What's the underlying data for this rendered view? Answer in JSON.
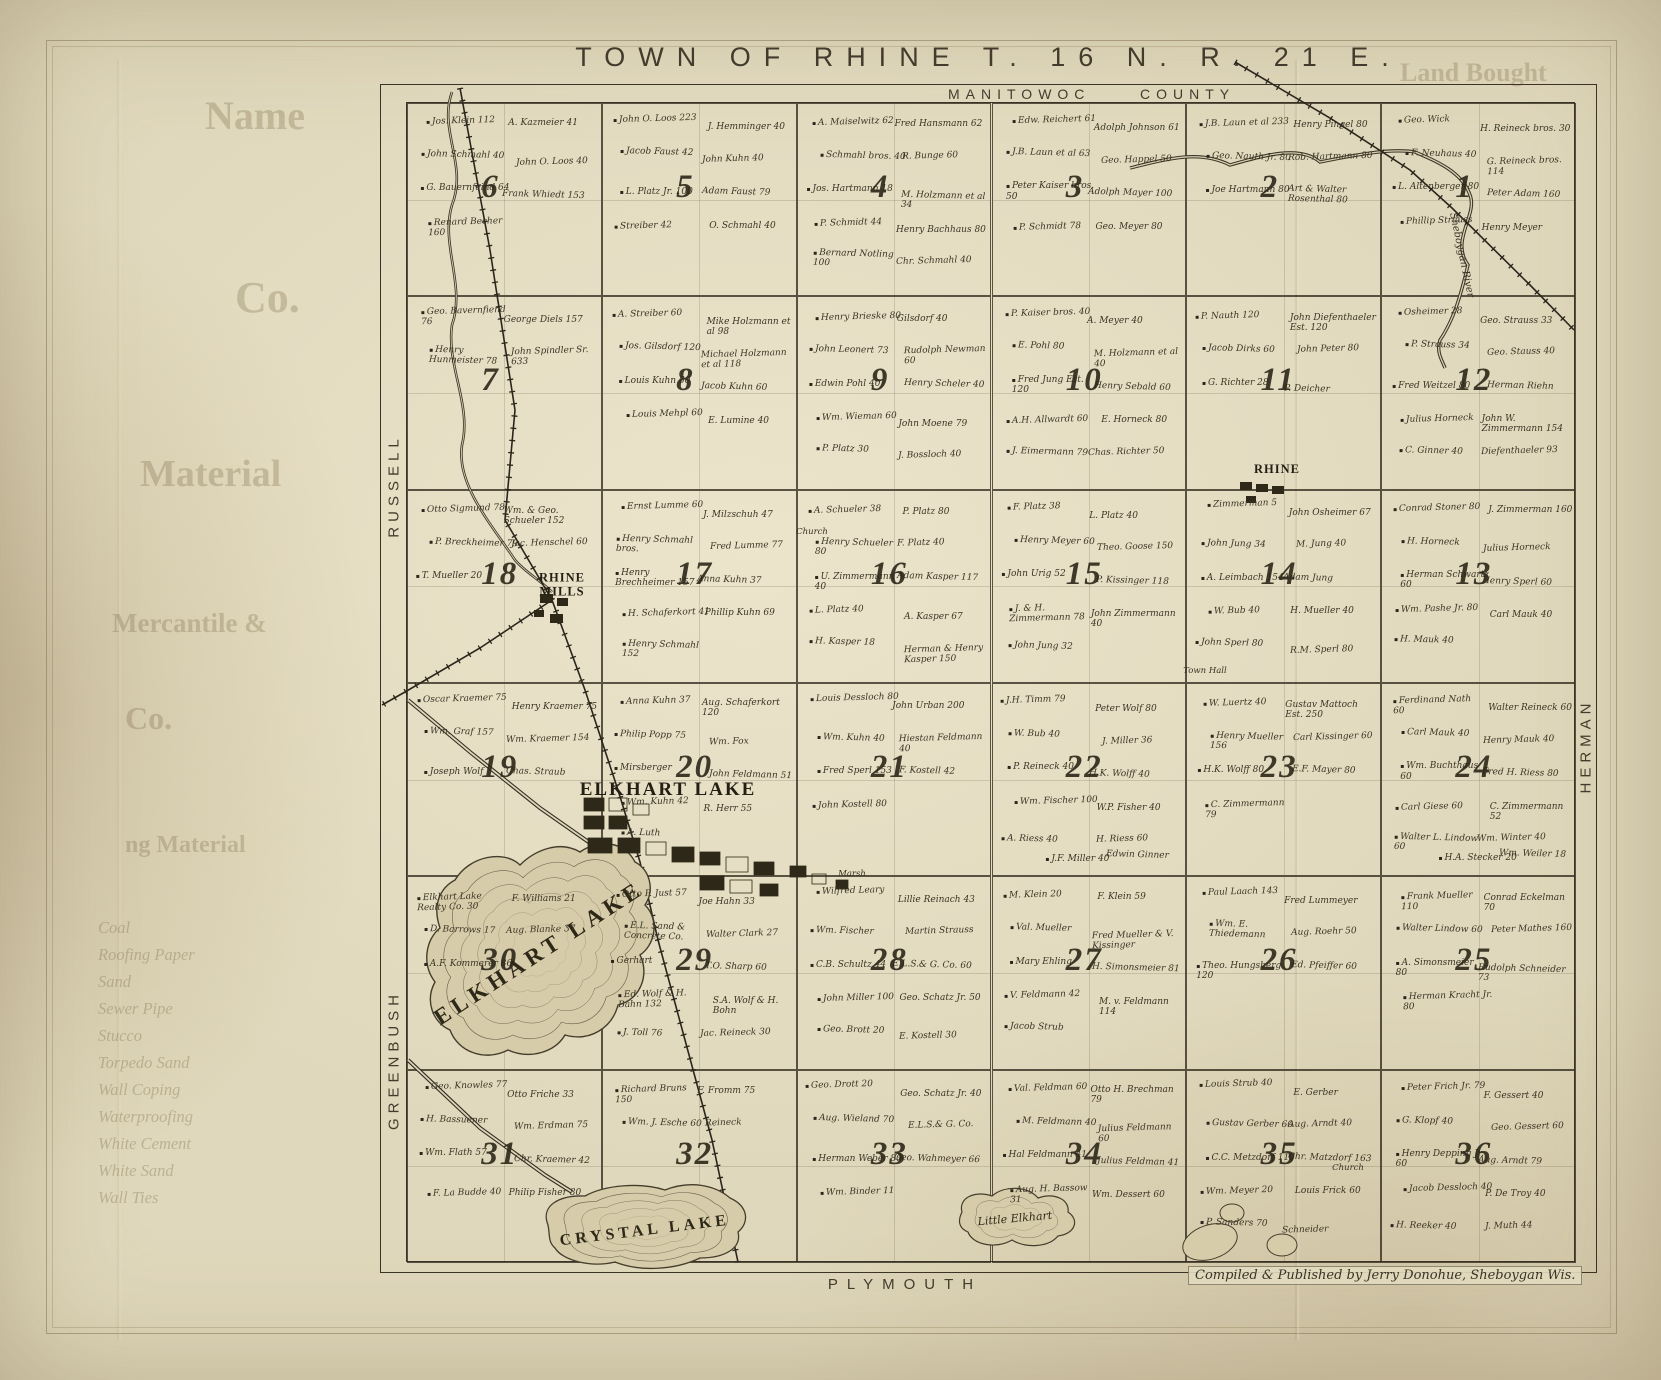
{
  "title": "TOWN OF RHINE T. 16 N. R. 21 E.",
  "top_labels": {
    "county_left": "MANITOWOC",
    "county_right": "COUNTY"
  },
  "edge_labels": {
    "west_upper": "RUSSELL",
    "west_lower": "GREENBUSH",
    "east": "HERMAN",
    "south": "PLYMOUTH"
  },
  "credit": "Compiled & Published by Jerry Donohue, Sheboygan Wis.",
  "villages": {
    "rhine_mills": "RHINE MILLS",
    "elkhart_lake": "ELKHART LAKE",
    "rhine": "RHINE"
  },
  "lakes": {
    "elkhart": "Elkhart Lake",
    "crystal": "Crystal Lake",
    "little_elkhart": "Little Elkhart"
  },
  "river": "Sheboygan River",
  "landmarks": {
    "town_hall": "Town Hall",
    "church": "Church",
    "marsh": "Marsh"
  },
  "sections": [
    {
      "num": 6,
      "owners": [
        "Jos. Klein 112",
        "A. Kazmeier 41",
        "John Schmahl 40",
        "John O. Loos 40",
        "G. Bauernfeind 64",
        "Frank Whiedt 153",
        "Renard Becher 160"
      ]
    },
    {
      "num": 5,
      "owners": [
        "John O. Loos 223",
        "J. Hemminger 40",
        "Jacob Faust 42",
        "John Kuhn 40",
        "L. Platz Jr. 100",
        "Adam Faust 79",
        "Streiber 42",
        "O. Schmahl 40"
      ]
    },
    {
      "num": 4,
      "owners": [
        "A. Maiselwitz 62",
        "Fred Hansmann 62",
        "Schmahl bros. 40",
        "R. Bunge 60",
        "Jos. Hartmann 18",
        "M. Holzmann et al 34",
        "P. Schmidt 44",
        "Henry Bachhaus 80",
        "Bernard Notling 100",
        "Chr. Schmahl 40"
      ]
    },
    {
      "num": 3,
      "owners": [
        "Edw. Reichert 61",
        "Adolph Johnson 61",
        "J.B. Laun et al 63",
        "Geo. Happel 50",
        "Peter Kaiser bros. 50",
        "Adolph Mayer 100",
        "P. Schmidt 78",
        "Geo. Meyer 80"
      ]
    },
    {
      "num": 2,
      "owners": [
        "J.B. Laun et al 233",
        "Henry Pingel 80",
        "Geo. Nauth Jr. 80",
        "Rob. Hartmann 80",
        "Joe Hartmann 80",
        "Art & Walter Rosenthal 80"
      ]
    },
    {
      "num": 1,
      "owners": [
        "Geo. Wick",
        "H. Reineck bros. 30",
        "F. Neuhaus 40",
        "G. Reineck bros. 114",
        "L. Altenberger 80",
        "Peter Adam 160",
        "Phillip Strauss",
        "Henry Meyer"
      ]
    },
    {
      "num": 7,
      "owners": [
        "Geo. Bavernfiend 76",
        "George Diels 157",
        "Henry Hunmeister 78",
        "John Spindler Sr. 633"
      ]
    },
    {
      "num": 8,
      "owners": [
        "A. Streiber 60",
        "Mike Holzmann et al 98",
        "Jos. Gilsdorf 120",
        "Michael Holzmann et al 118",
        "Louis Kuhn 60",
        "Jacob Kuhn 60",
        "Louis Mehpl 60",
        "E. Lumine 40"
      ]
    },
    {
      "num": 9,
      "owners": [
        "Henry Brieske 80",
        "Gilsdorf 40",
        "John Leonert 73",
        "Rudolph Newman 60",
        "Edwin Pohl 40",
        "Henry Scheler 40",
        "Wm. Wieman 60",
        "John Moene 79",
        "P. Platz 30",
        "J. Bossloch 40"
      ]
    },
    {
      "num": 10,
      "owners": [
        "P. Kaiser bros. 40",
        "A. Meyer 40",
        "E. Pohl 80",
        "M. Holzmann et al 40",
        "Fred Jung Est. 120",
        "Henry Sebald 60",
        "A.H. Allwardt 60",
        "E. Horneck 80",
        "J. Eimermann 79",
        "Chas. Richter 50"
      ]
    },
    {
      "num": 11,
      "owners": [
        "P. Nauth 120",
        "John Diefenthaeler Est. 120",
        "Jacob Dirks 60",
        "John Peter 80",
        "G. Richter 28",
        "P. Deicher"
      ]
    },
    {
      "num": 12,
      "owners": [
        "Osheimer 28",
        "Geo. Strauss 33",
        "P. Strauss 34",
        "Geo. Stauss 40",
        "Fred Weitzel 80",
        "Herman Riehn",
        "Julius Horneck",
        "John W. Zimmermann 154",
        "C. Ginner 40",
        "Diefenthaeler 93"
      ]
    },
    {
      "num": 18,
      "owners": [
        "Otto Sigmund 78",
        "Wm. & Geo. Schueler 152",
        "P. Breckheimer 79",
        "Jac. Henschel 60",
        "T. Mueller 20"
      ]
    },
    {
      "num": 17,
      "owners": [
        "Ernst Lumme 60",
        "J. Milzschuh 47",
        "Henry Schmahl bros.",
        "Fred Lumme 77",
        "Henry Brechheimer 157",
        "Anna Kuhn 37",
        "H. Schaferkort 41",
        "Phillip Kuhn 69",
        "Henry Schmahl 152"
      ]
    },
    {
      "num": 16,
      "owners": [
        "A. Schueler 38",
        "P. Platz 80",
        "Henry Schueler 80",
        "F. Platz 40",
        "U. Zimmermann 40",
        "Adam Kasper 117",
        "L. Platz 40",
        "A. Kasper 67",
        "H. Kasper 18",
        "Herman & Henry Kasper 150"
      ]
    },
    {
      "num": 15,
      "owners": [
        "F. Platz 38",
        "L. Platz 40",
        "Henry Meyer 60",
        "Theo. Goose 150",
        "John Urig 52",
        "P. Kissinger 118",
        "J. & H. Zimmermann 78",
        "John Zimmermann 40",
        "John Jung 32"
      ]
    },
    {
      "num": 14,
      "owners": [
        "Zimmerman 5",
        "John Osheimer 67",
        "John Jung 34",
        "M. Jung 40",
        "A. Leimbach 154",
        "Adam Jung",
        "W. Bub 40",
        "H. Mueller 40",
        "John Sperl 80",
        "R.M. Sperl 80"
      ]
    },
    {
      "num": 13,
      "owners": [
        "Conrad Stoner 80",
        "J. Zimmerman 160",
        "H. Horneck",
        "Julius Horneck",
        "Herman Schwartz 60",
        "Henry Sperl 60",
        "Wm. Pashe Jr. 80",
        "Carl Mauk 40",
        "H. Mauk 40"
      ]
    },
    {
      "num": 19,
      "owners": [
        "Oscar Kraemer 75",
        "Henry Kraemer 75",
        "Wm. Graf 157",
        "Wm. Kraemer 154",
        "Joseph Wolf",
        "Chas. Straub"
      ]
    },
    {
      "num": 20,
      "owners": [
        "Anna Kuhn 37",
        "Aug. Schaferkort 120",
        "Philip Popp 75",
        "Wm. Fox",
        "Mirsberger",
        "John Feldmann 51",
        "Wm. Kuhn 42",
        "R. Herr 55",
        "A. Luth"
      ]
    },
    {
      "num": 21,
      "owners": [
        "Louis Dessloch 80",
        "John Urban 200",
        "Wm. Kuhn 40",
        "Hiestan Feldmann 40",
        "Fred Sperl 153",
        "F. Kostell 42",
        "John Kostell 80"
      ]
    },
    {
      "num": 22,
      "owners": [
        "J.H. Timm 79",
        "Peter Wolf 80",
        "W. Bub 40",
        "J. Miller 36",
        "P. Reineck 40",
        "H.K. Wolff 40",
        "Wm. Fischer 100",
        "W.P. Fisher 40",
        "A. Riess 40",
        "H. Riess 60",
        "J.F. Miller 40",
        "Edwin Ginner"
      ]
    },
    {
      "num": 23,
      "owners": [
        "W. Luertz 40",
        "Gustav Mattoch Est. 250",
        "Henry Mueller 156",
        "Carl Kissinger 60",
        "H.K. Wolff 80",
        "E.F. Mayer 80",
        "C. Zimmermann 79"
      ]
    },
    {
      "num": 24,
      "owners": [
        "Ferdinand Nath 60",
        "Walter Reineck 60",
        "Carl Mauk 40",
        "Henry Mauk 40",
        "Wm. Buchthaus 60",
        "Fred H. Riess 80",
        "Carl Giese 60",
        "C. Zimmermann 52",
        "Walter L. Lindow 60",
        "Wm. Winter 40",
        "H.A. Stecker 20",
        "Wm. Weiler 18"
      ]
    },
    {
      "num": 30,
      "owners": [
        "Elkhart Lake Realty Co. 30",
        "F. Williams 21",
        "D. Barrows 17",
        "Aug. Blanke 37",
        "A.F. Kommerer 86"
      ]
    },
    {
      "num": 29,
      "owners": [
        "Otto P. Just 57",
        "Joe Hahn 33",
        "E.L. Sand & Concrete Co.",
        "Walter Clark 27",
        "Gerhart",
        "T.O. Sharp 60",
        "Ed. Wolf & H. Bahn 132",
        "S.A. Wolf & H. Bohn",
        "J. Toll 76",
        "Jac. Reineck 30"
      ]
    },
    {
      "num": 28,
      "owners": [
        "Wilfred Leary",
        "Lillie Reinach 43",
        "Wm. Fischer",
        "Martin Strauss",
        "C.B. Schultz 44",
        "E.L.S.& G. Co. 60",
        "John Miller 100",
        "Geo. Schatz Jr. 50",
        "Geo. Brott 20",
        "E. Kostell 30"
      ]
    },
    {
      "num": 27,
      "owners": [
        "M. Klein 20",
        "F. Klein 59",
        "Val. Mueller",
        "Fred Mueller & V. Kissinger",
        "Mary Ehling",
        "H. Simonsmeier 81",
        "V. Feldmann 42",
        "M. v. Feldmann 114",
        "Jacob Strub"
      ]
    },
    {
      "num": 26,
      "owners": [
        "Paul Laach 143",
        "Fred Lummeyer",
        "Wm. E. Thiedemann",
        "Aug. Roehr 50",
        "Theo. Hungsberg 120",
        "Ed. Pfeiffer 60"
      ]
    },
    {
      "num": 25,
      "owners": [
        "Frank Mueller 110",
        "Conrad Eckelman 70",
        "Walter Lindow 60",
        "Peter Mathes 160",
        "A. Simonsmeier 80",
        "Rudolph Schneider 73",
        "Herman Kracht Jr. 80"
      ]
    },
    {
      "num": 31,
      "owners": [
        "Geo. Knowles 77",
        "Otto Friche 33",
        "H. Bassuener",
        "Wm. Erdman 75",
        "Wm. Flath 57",
        "Chr. Kraemer 42",
        "F. La Budde 40",
        "Philip Fisher 80"
      ]
    },
    {
      "num": 32,
      "owners": [
        "Richard Bruns 150",
        "F. Fromm 75",
        "Wm. J. Esche 60",
        "Reineck"
      ]
    },
    {
      "num": 33,
      "owners": [
        "Geo. Drott 20",
        "Geo. Schatz Jr. 40",
        "Aug. Wieland 70",
        "E.L.S.& G. Co.",
        "Herman Weber 80",
        "Geo. Wahmeyer 66",
        "Wm. Binder 11"
      ]
    },
    {
      "num": 34,
      "owners": [
        "Val. Feldman 60",
        "Otto H. Brechman 79",
        "M. Feldmann 40",
        "Julius Feldmann 60",
        "Hal Feldmann 41",
        "Julius Feldman 41",
        "Aug. H. Bassow 31",
        "Wm. Dessert 60"
      ]
    },
    {
      "num": 35,
      "owners": [
        "Louis Strub 40",
        "E. Gerber",
        "Gustav Gerber 60",
        "Aug. Arndt 40",
        "C.C. Metzdorf 110",
        "Chr. Matzdorf 163",
        "Wm. Meyer 20",
        "Louis Frick 60",
        "P. Sanders 70",
        "Schneider"
      ]
    },
    {
      "num": 36,
      "owners": [
        "Peter Frich Jr. 79",
        "F. Gessert 40",
        "G. Klopf 40",
        "Geo. Gessert 60",
        "Henry Depping Jr. 60",
        "Aug. Arndt 79",
        "Jacob Dessloch 40",
        "P. De Troy 40",
        "H. Reeker 40",
        "J. Muth 44"
      ]
    }
  ],
  "bleedthrough": {
    "words": [
      "Land Bought",
      "Name",
      "Co.",
      "Material",
      "Mercantile &",
      "Co.",
      "ng Material"
    ],
    "list": [
      "Coal",
      "Roofing Paper",
      "Sand",
      "Sewer Pipe",
      "Stucco",
      "Torpedo Sand",
      "Wall Coping",
      "Waterproofing",
      "White Cement",
      "White Sand",
      "Wall Ties"
    ]
  }
}
